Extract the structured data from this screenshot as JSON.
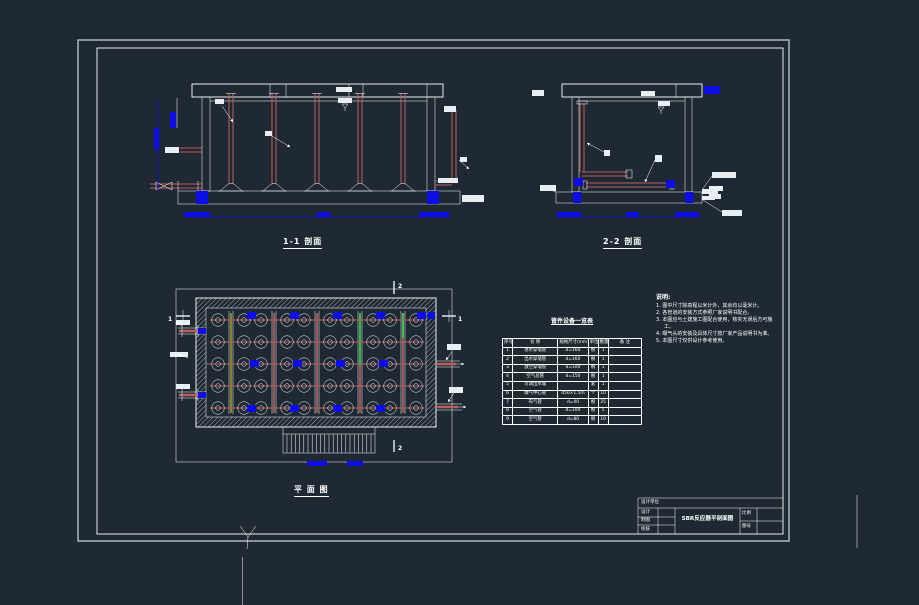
{
  "colors": {
    "background": "#1e2933",
    "line": "#ffffff",
    "pipe_red": "#bb5f5f",
    "dimension_blue": "#0d0de6",
    "highlight_green": "#35e04a",
    "highlight_olive": "#9b9b1e"
  },
  "labels": {
    "section1": "1-1 剖面",
    "section2": "2-2 剖面",
    "plan": "平 面 图",
    "cut1": "1",
    "cut2": "2"
  },
  "notes": {
    "title": "说明:",
    "items": [
      "1. 图中尺寸除高程以米计外，其余均以毫米计。",
      "2. 各管道的安装方式参照厂家说明书配合。",
      "3. 本图应与土建施工图配合使用，核实无误后方可施工。",
      "4. 曝气头的安装及具体尺寸按厂家产品说明书为准。",
      "5. 本图尺寸仅供设计参考使用。"
    ]
  },
  "table": {
    "title": "管件设备一览表",
    "headers": [
      "序号",
      "名 称",
      "规格尺寸(mm)",
      "单位",
      "数量",
      "备 注"
    ],
    "rows": [
      [
        "1",
        "进水穿墙管",
        "d=160",
        "根",
        "1",
        ""
      ],
      [
        "2",
        "出水穿墙管",
        "d=160",
        "根",
        "1",
        ""
      ],
      [
        "3",
        "放空穿墙管",
        "d=100",
        "根",
        "1",
        ""
      ],
      [
        "4",
        "空气总管",
        "d=150",
        "根",
        "1",
        ""
      ],
      [
        "5",
        "可调出水堰",
        "",
        "套",
        "1",
        ""
      ],
      [
        "6",
        "曝气中心管",
        "d50×1.5m",
        "个",
        "10",
        ""
      ],
      [
        "7",
        "布气管",
        "d=40",
        "根",
        "25",
        ""
      ],
      [
        "8",
        "空气管",
        "d=100",
        "根",
        "5",
        ""
      ],
      [
        "9",
        "空气管",
        "d=80",
        "根",
        "10",
        ""
      ]
    ]
  },
  "title_block": {
    "org": "设计单位",
    "row1": "设计",
    "row2": "制图",
    "row3": "校核",
    "title": "SBR反应器平剖面图",
    "scale_label": "比例",
    "no_label": "图号"
  }
}
